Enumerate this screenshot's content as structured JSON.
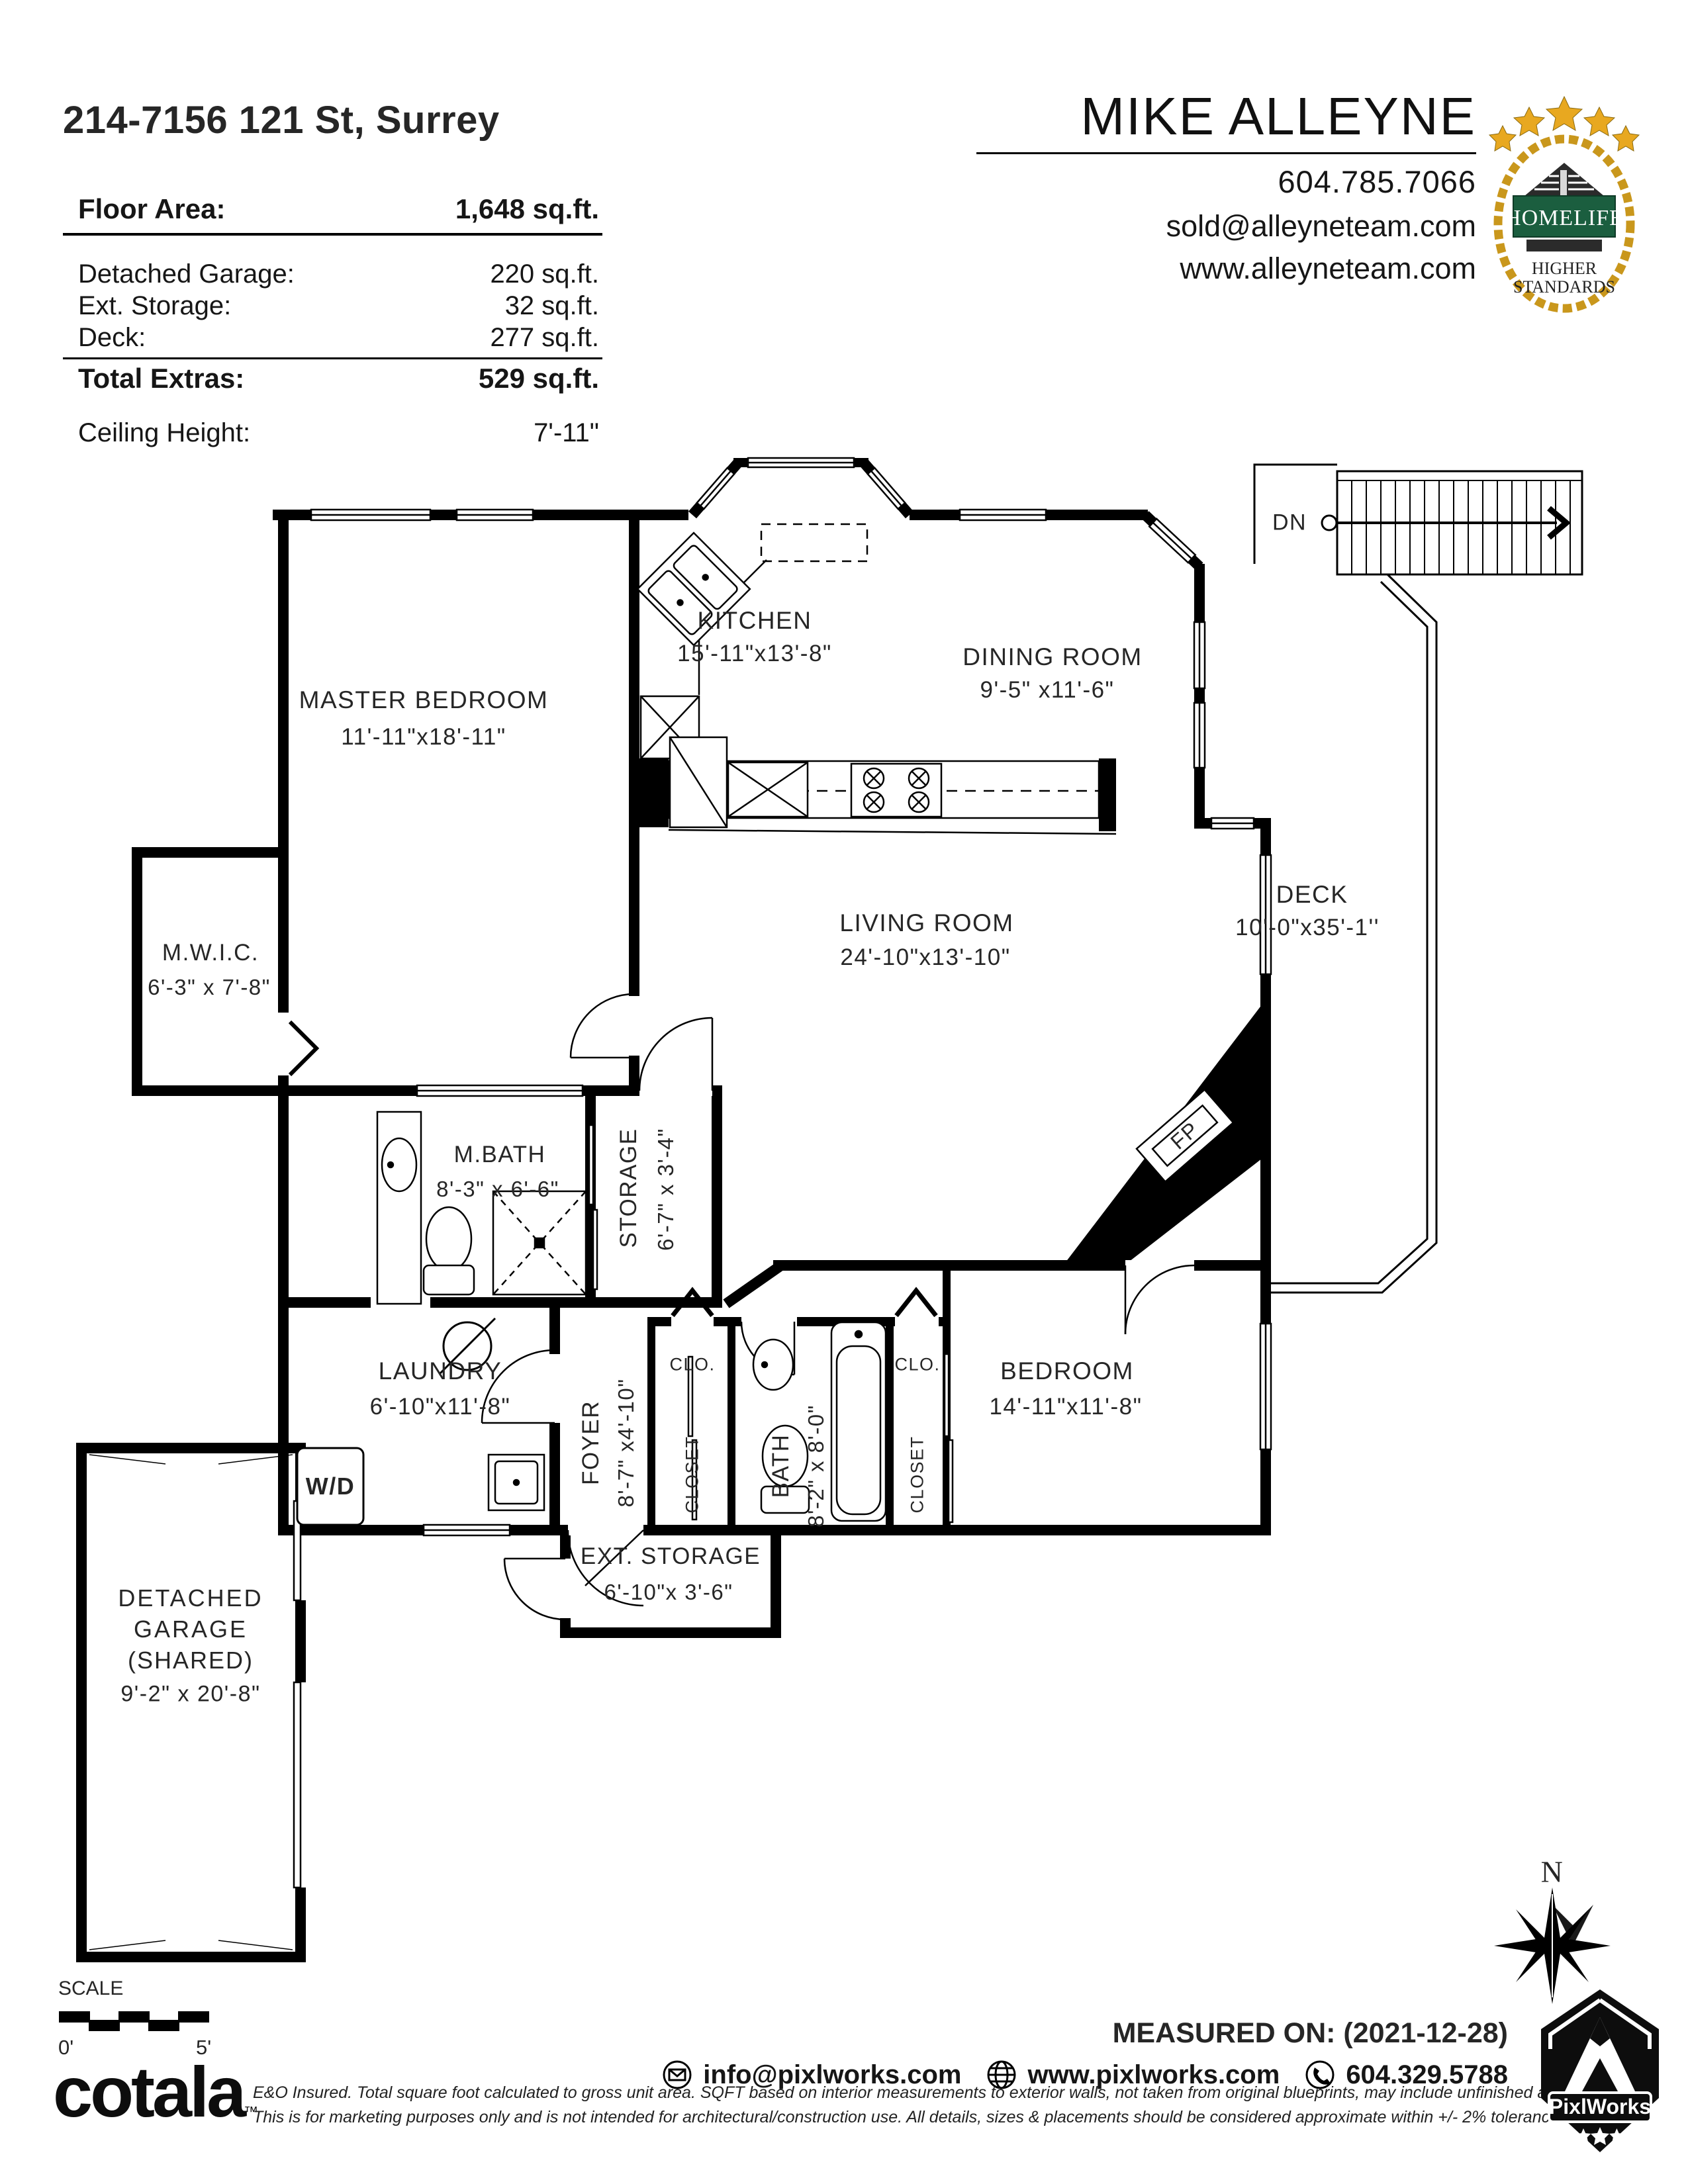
{
  "header": {
    "address": "214-7156 121 St, Surrey",
    "floor_area_label": "Floor Area:",
    "floor_area_value": "1,648 sq.ft.",
    "extras": [
      {
        "label": "Detached Garage:",
        "value": "220 sq.ft."
      },
      {
        "label": "Ext. Storage:",
        "value": "32 sq.ft."
      },
      {
        "label": "Deck:",
        "value": "277 sq.ft."
      }
    ],
    "total_extras_label": "Total Extras:",
    "total_extras_value": "529 sq.ft.",
    "ceiling_label": "Ceiling Height:",
    "ceiling_value": "7'-11\""
  },
  "agent": {
    "name": "MIKE ALLEYNE",
    "phone": "604.785.7066",
    "email": "sold@alleyneteam.com",
    "website": "www.alleyneteam.com",
    "brand": {
      "name": "HOMELIFE",
      "tagline1": "HIGHER",
      "tagline2": "STANDARDS"
    }
  },
  "rooms": {
    "master": {
      "name": "MASTER BEDROOM",
      "dims": "11'-11\"x18'-11\""
    },
    "kitchen": {
      "name": "KITCHEN",
      "dims": "15'-11\"x13'-8\""
    },
    "dining": {
      "name": "DINING ROOM",
      "dims": "9'-5\" x11'-6\""
    },
    "living": {
      "name": "LIVING ROOM",
      "dims": "24'-10\"x13'-10\""
    },
    "deck": {
      "name": "DECK",
      "dims": "10'-0\"x35'-1''"
    },
    "mwic": {
      "name": "M.W.I.C.",
      "dims": "6'-3\" x 7'-8\""
    },
    "mbath": {
      "name": "M.BATH",
      "dims": "8'-3\" x 6'-6\""
    },
    "storage": {
      "name": "STORAGE",
      "dims": "6'-7\" x 3'-4\""
    },
    "laundry": {
      "name": "LAUNDRY",
      "dims": "6'-10\"x11'-8\""
    },
    "foyer": {
      "name": "FOYER",
      "dims": "8'-7\" x4'-10\""
    },
    "bath": {
      "name": "BATH",
      "dims": "8'-2\" x 8'-0\""
    },
    "bedroom": {
      "name": "BEDROOM",
      "dims": "14'-11\"x11'-8\""
    },
    "extstorage": {
      "name": "EXT. STORAGE",
      "dims": "6'-10\"x 3'-6\""
    },
    "garage": {
      "line1": "DETACHED",
      "line2": "GARAGE",
      "line3": "(SHARED)",
      "dims": "9'-2\" x 20'-8\""
    },
    "clo1": "CLO.",
    "clo2": "CLO.",
    "closet1": "CLOSET",
    "closet2": "CLOSET",
    "wd": "W/D",
    "fp": "FP",
    "dn": "DN"
  },
  "compass": {
    "north": "N"
  },
  "scalebar": {
    "label": "SCALE",
    "start": "0'",
    "end": "5'"
  },
  "footer": {
    "measured_on": "MEASURED ON: (2021-12-28)",
    "email": "info@pixlworks.com",
    "website": "www.pixlworks.com",
    "phone": "604.329.5788",
    "disclaimer1": "E&O Insured.  Total square foot calculated to gross unit area. SQFT based on interior measurements to exterior walls, not taken from original blueprints, may include unfinished area.",
    "disclaimer2": "This is for marketing purposes only and is not intended for architectural/construction use.   All details, sizes & placements should be considered approximate within +/- 2%  tolerance.",
    "cotala": "cotala",
    "cotala_tm": "™",
    "pixlworks": "PixlWorks"
  }
}
